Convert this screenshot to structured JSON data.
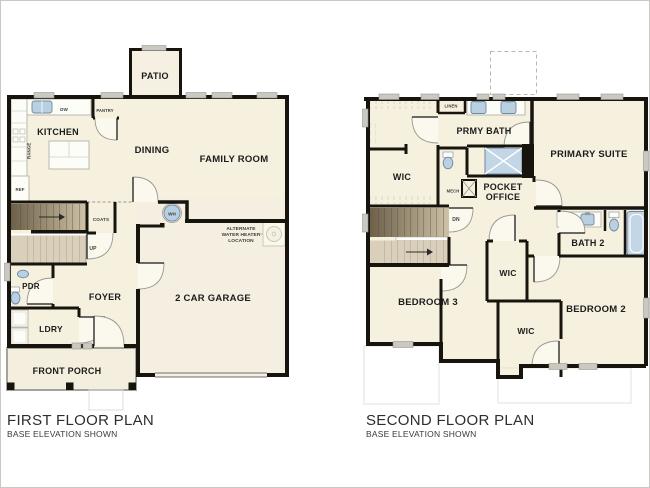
{
  "page": {
    "background": "#ffffff",
    "border_color": "#c9c9c4"
  },
  "colors": {
    "floor": "#f6f0df",
    "wall": "#17130d",
    "fixture_blue": "#b9d0e3",
    "stair_dark": "#6b5d46",
    "stair_light": "#d9cfba",
    "window_sill": "#c9c8c1",
    "label_text": "#1c1c1c"
  },
  "first_floor": {
    "title": "FIRST FLOOR PLAN",
    "subtitle": "BASE ELEVATION SHOWN",
    "rooms": {
      "patio": "PATIO",
      "kitchen": "KITCHEN",
      "dining": "DINING",
      "family_room": "FAMILY ROOM",
      "foyer": "FOYER",
      "powder": "PDR",
      "laundry": "LDRY",
      "front_porch": "FRONT PORCH",
      "garage": "2 CAR GARAGE"
    },
    "labels": {
      "dishwasher": "DW",
      "pantry": "PANTRY",
      "range": "RANGE",
      "refrigerator": "REF",
      "coats": "COATS",
      "up": "UP",
      "water_heater": "WH",
      "alt_water_heater": [
        "ALTERNATE",
        "WATER HEATER",
        "LOCATION"
      ]
    }
  },
  "second_floor": {
    "title": "SECOND FLOOR PLAN",
    "subtitle": "BASE ELEVATION SHOWN",
    "rooms": {
      "primary_suite": "PRIMARY SUITE",
      "primary_bath": "PRMY BATH",
      "pocket_office": [
        "POCKET",
        "OFFICE"
      ],
      "wic_primary": "WIC",
      "bath2": "BATH 2",
      "bedroom3": "BEDROOM 3",
      "wic_hall": "WIC",
      "wic_bedroom2": "WIC",
      "bedroom2": "BEDROOM 2"
    },
    "labels": {
      "linen": "LINEN",
      "mech": "MECH",
      "down": "DN"
    }
  }
}
